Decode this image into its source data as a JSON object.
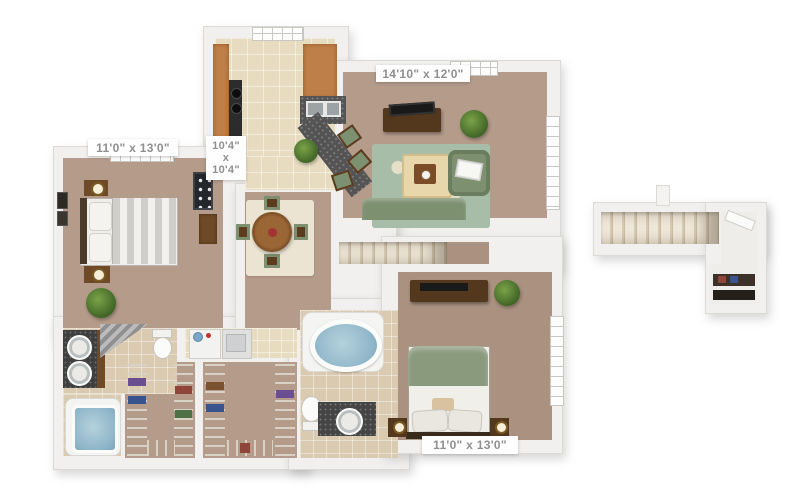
{
  "dimension_labels": {
    "bedroom_top_left": "11'0\" x 13'0\"",
    "kitchen_width": "10'4\"",
    "kitchen_sep": "x",
    "kitchen_depth": "10'4\"",
    "living_room": "14'10\" x 12'0\"",
    "bedroom_bottom_right": "11'0\" x 13'0\""
  },
  "palette": {
    "wall": "#f1f0ee",
    "carpet": "#b49b8a",
    "bedroom2_carpet": "#ab9280",
    "kitchen_tile": "#e8dcc0",
    "bath_tile": "#d9cab0",
    "upholstery_green": "#7d9070",
    "living_rug_green": "#a8bda7",
    "dining_rug_cream": "#ece4d2",
    "dark_wood": "#53381e",
    "cabinet_wood": "#bf7f48",
    "granite_counter": "#545454",
    "tub_water": "#8fb6c9",
    "label_text": "#8f8f8f",
    "label_background": "#fefefe"
  }
}
